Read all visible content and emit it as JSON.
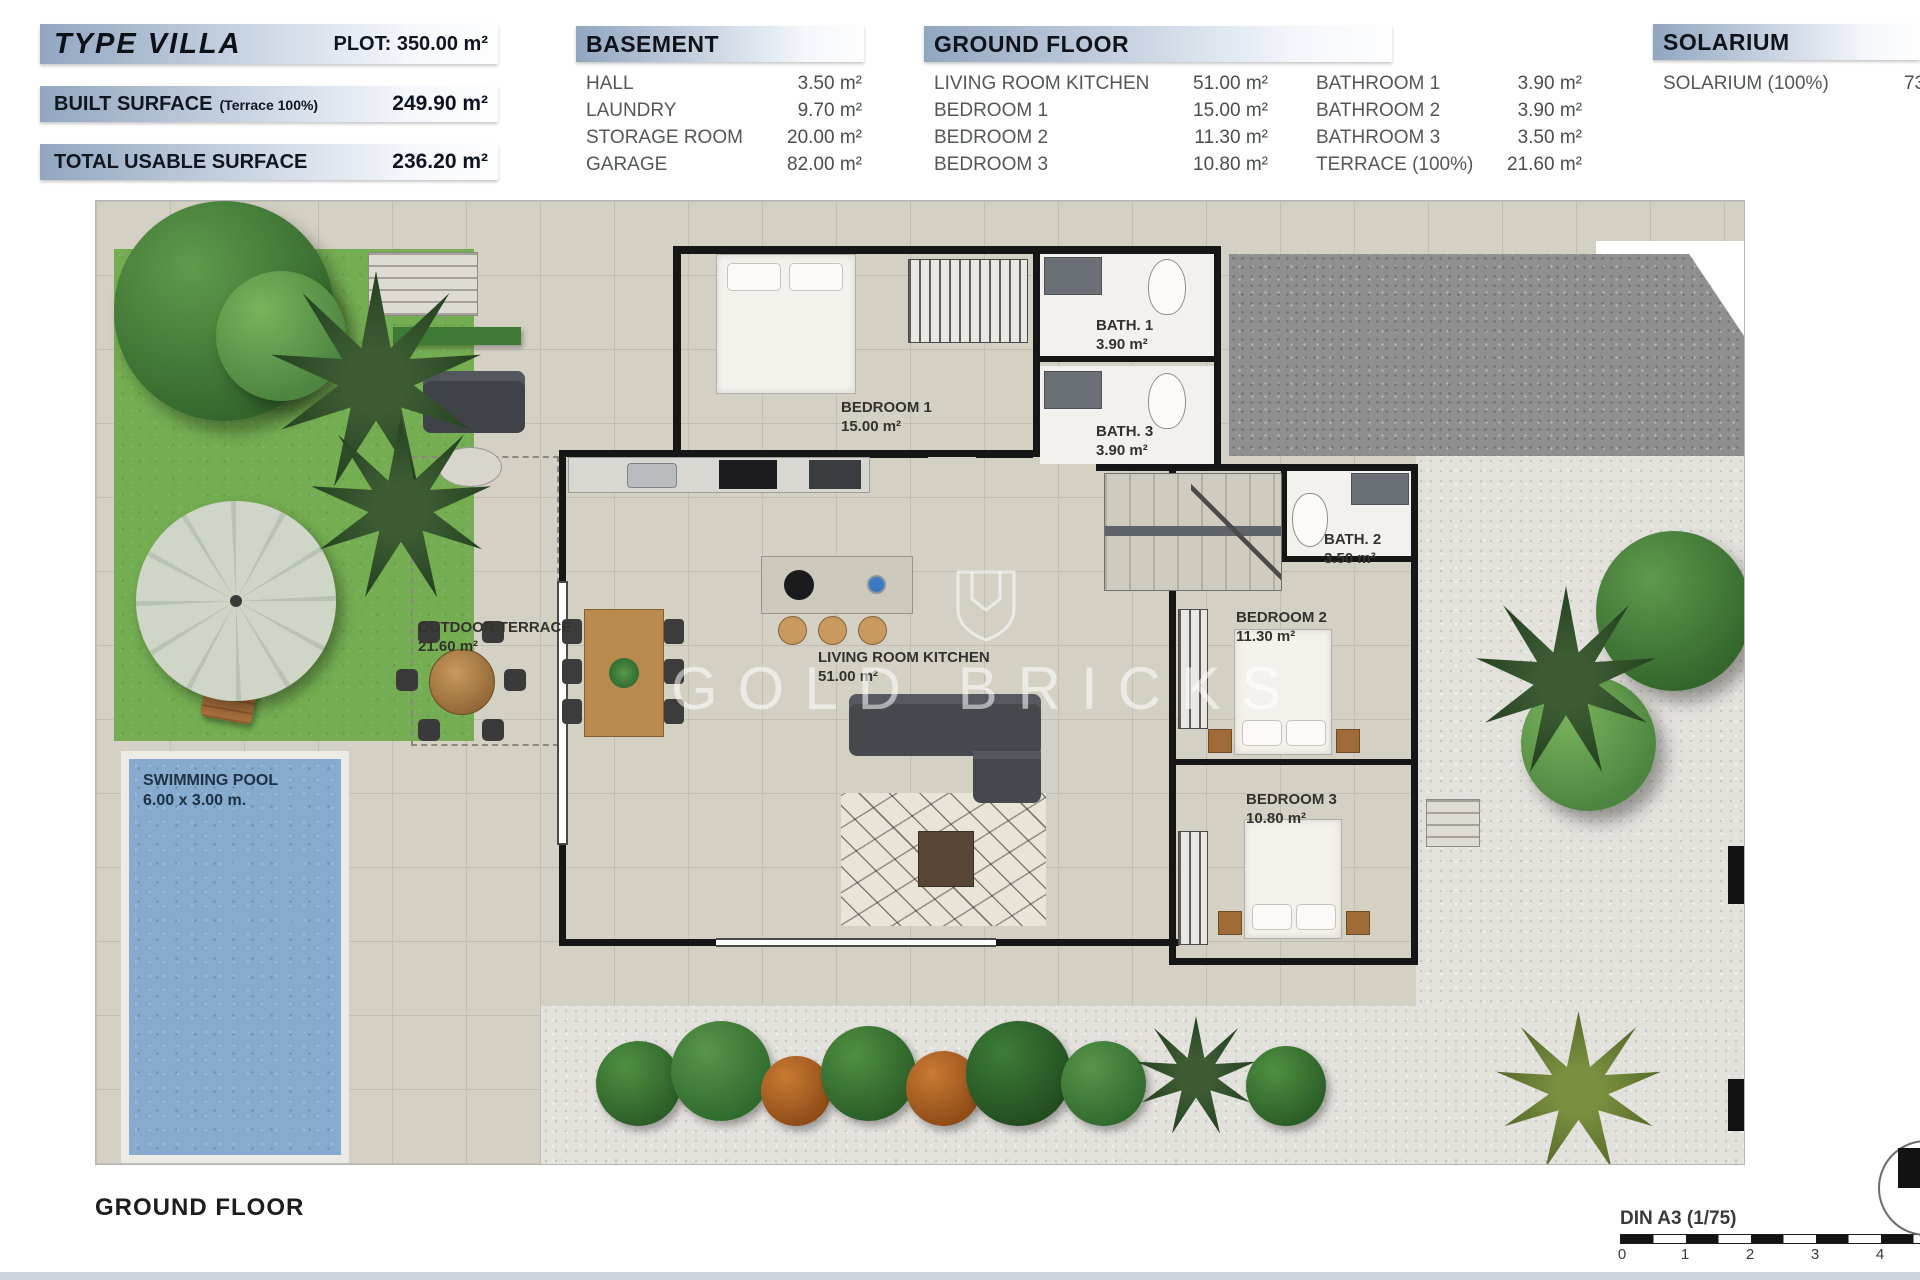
{
  "header": {
    "summary": {
      "type_label": "TYPE VILLA",
      "plot": "PLOT: 350.00 m²",
      "rows": [
        {
          "label": "BUILT SURFACE",
          "note": "(Terrace 100%)",
          "value": "249.90 m²"
        },
        {
          "label": "TOTAL USABLE SURFACE",
          "note": "",
          "value": "236.20 m²"
        }
      ]
    },
    "basement": {
      "title": "BASEMENT",
      "rows": [
        {
          "label": "HALL",
          "value": "3.50 m²"
        },
        {
          "label": "LAUNDRY",
          "value": "9.70 m²"
        },
        {
          "label": "STORAGE ROOM",
          "value": "20.00 m²"
        },
        {
          "label": "GARAGE",
          "value": "82.00 m²"
        }
      ]
    },
    "ground_floor": {
      "title": "GROUND FLOOR",
      "col1": [
        {
          "label": "LIVING ROOM KITCHEN",
          "value": "51.00 m²"
        },
        {
          "label": "BEDROOM 1",
          "value": "15.00 m²"
        },
        {
          "label": "BEDROOM 2",
          "value": "11.30 m²"
        },
        {
          "label": "BEDROOM 3",
          "value": "10.80 m²"
        }
      ],
      "col2": [
        {
          "label": "BATHROOM 1",
          "value": "3.90 m²"
        },
        {
          "label": "BATHROOM 2",
          "value": "3.90 m²"
        },
        {
          "label": "BATHROOM 3",
          "value": "3.50 m²"
        },
        {
          "label": "TERRACE (100%)",
          "value": "21.60 m²"
        }
      ]
    },
    "solarium": {
      "title": "SOLARIUM",
      "rows": [
        {
          "label": "SOLARIUM (100%)",
          "value": "73.30 m²"
        }
      ]
    }
  },
  "plan": {
    "rooms": [
      {
        "name": "BEDROOM 1",
        "area": "15.00 m²"
      },
      {
        "name": "BATH. 1",
        "area": "3.90 m²"
      },
      {
        "name": "BATH. 3",
        "area": "3.90 m²"
      },
      {
        "name": "BATH. 2",
        "area": "3.50 m²"
      },
      {
        "name": "BEDROOM 2",
        "area": "11.30 m²"
      },
      {
        "name": "BEDROOM 3",
        "area": "10.80 m²"
      },
      {
        "name": "OUTDOOR TERRACE",
        "area": "21.60 m²"
      },
      {
        "name": "LIVING ROOM KITCHEN",
        "area": "51.00 m²"
      },
      {
        "name": "SWIMMING POOL",
        "area": "6.00 x 3.00 m."
      }
    ],
    "watermark": "GOLD BRICKS"
  },
  "footer": {
    "floor_title": "GROUND FLOOR",
    "scale_label": "DIN A3 (1/75)",
    "ticks": [
      "0",
      "1",
      "2",
      "3",
      "4"
    ]
  },
  "colors": {
    "header_gradient_start": "#91a6c0",
    "grass": "#74ad52",
    "pool_water": "#86abce",
    "tile": "#d4d0c4",
    "gravel_dark": "#8f8f8f",
    "gravel_light": "#e3e1dc",
    "wall": "#161616",
    "wood": "#b9894d"
  }
}
